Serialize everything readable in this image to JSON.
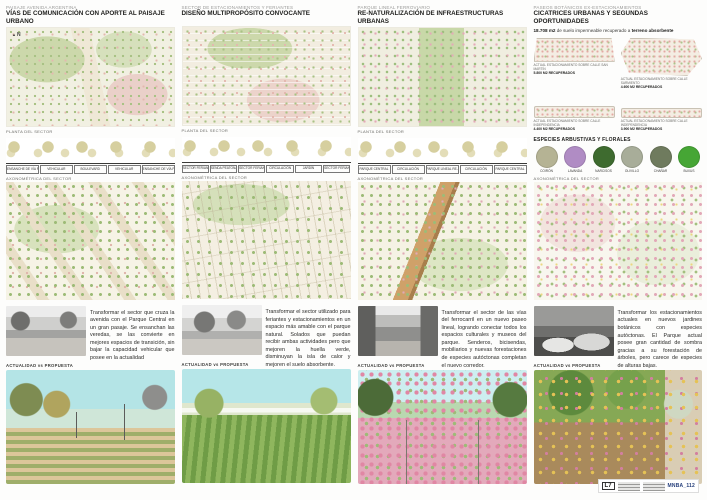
{
  "columns": [
    {
      "kicker": "PAISAJE AVENIDA ARGENTINA",
      "title": "VÍAS DE COMUNICACIÓN CON APORTE AL PAISAJE URBANO",
      "compass": "N",
      "plan_caption": "PLANTA DEL SECTOR",
      "section_labels": [
        "ENSANCHE DE VÍA PEATONAL",
        "VEHICULAR",
        "BOULEVARD",
        "VEHICULAR",
        "ENSANCHE DE VÍA PEATONAL"
      ],
      "axon_caption": "AXONOMÉTRICA DEL SECTOR",
      "body": "Transformar el sector que cruza la avenida con el Parque Central en un gran pasaje. Se ensanchan las veredas, se las convierte en mejores espacios de transición, sin bajar la capacidad vehicular que posee en la actualidad",
      "vs_caption": "ACTUALIDAD vs PROPUESTA"
    },
    {
      "kicker": "SECTOR DE ESTACIONAMIENTOS Y FERIANTES",
      "title": "DISEÑO MULTIPROPÓSITO CONVOCANTE",
      "plan_caption": "PLANTA DEL SECTOR",
      "section_labels": [
        "SECTOR FERIANTES",
        "SENDA PEATONAL",
        "SECTOR FERIANTES",
        "CIRCULACIÓN",
        "JARDÍN",
        "SECTOR FERIANTES"
      ],
      "axon_caption": "AXONOMÉTRICA DEL SECTOR",
      "body": "Transformar el sector utilizado para feriantes y estacionamientos en un espacio más amable con el parque natural. Solados que puedan recibir ambas actividades pero que mejoren la huella verde, disminuyan la isla de calor y mejoren el suelo absorbente.",
      "vs_caption": "ACTUALIDAD vs PROPUESTA"
    },
    {
      "kicker": "PARQUE LINEAL FERROVIARIO",
      "title": "RE-NATURALIZACIÓN DE INFRAESTRUCTURAS URBANAS",
      "plan_caption": "PLANTA DEL SECTOR",
      "section_labels": [
        "PARQUE CENTRAL",
        "CIRCULACIÓN",
        "PARQUE LINEAL RE-NATURALIZADO",
        "CIRCULACIÓN",
        "PARQUE CENTRAL"
      ],
      "axon_caption": "AXONOMÉTRICA DEL SECTOR",
      "body": "Transformar el sector de las vías del ferrocarril en un nuevo paseo lineal, logrando conectar todos los espacios culturales y museos del parque. Senderos, bicisendas, mobiliarios y nuevas forestaciones de especies autóctonas completan el nuevo corredor.",
      "vs_caption": "ACTUALIDAD vs PROPUESTA"
    },
    {
      "kicker": "PASEOS BOTÁNICOS EX-ESTACIONAMIENTOS",
      "title": "CICATRICES URBANAS Y SEGUNDAS OPORTUNIDADES",
      "stat_area": "18.708 m2",
      "stat_mid": "de suelo impermeable recuperado a",
      "stat_bold2": "terreno absorbente",
      "lots": [
        {
          "caption": "ACTUAL ESTACIONAMIENTO SOBRE CALLE SAN MARTÍN",
          "area": "5.800 m2 recuperados"
        },
        {
          "caption": "ACTUAL ESTACIONAMIENTO SOBRE CALLE SARMIENTO",
          "area": "4.600 m2 recuperados"
        },
        {
          "caption": "ACTUAL ESTACIONAMIENTO SOBRE CALLE INDEPENDENCIA",
          "area": "4.400 m2 recuperados"
        },
        {
          "caption": "ACTUAL ESTACIONAMIENTO SOBRE CALLE INDEPENDENCIA",
          "area": "3.900 m2 recuperados"
        }
      ],
      "species_title": "ESPECIES ARBUSTIVAS Y FLORALES",
      "species": [
        {
          "name": "COIRÓN",
          "color": "#b5b394"
        },
        {
          "name": "LAVANDA",
          "color": "#b08cc4"
        },
        {
          "name": "NARCISOS",
          "color": "#3e6b2f"
        },
        {
          "name": "OLIVILLO",
          "color": "#a8ad99"
        },
        {
          "name": "CHAÑAR",
          "color": "#6f7b5e"
        },
        {
          "name": "BUXUS",
          "color": "#46a635"
        }
      ],
      "axon_caption": "AXONOMÉTRICA DEL SECTOR",
      "body": "Transformar los estacionamientos actuales en nuevos jardines botánicos con especies autóctonas. El Parque actual posee gran cantidad de sombra gracias a su forestación de árboles, pero carece de especies de alturas bajas.",
      "vs_caption": "ACTUALIDAD vs PROPUESTA"
    }
  ],
  "footer": {
    "plate_id": "L7",
    "code": "MNBA_112"
  }
}
